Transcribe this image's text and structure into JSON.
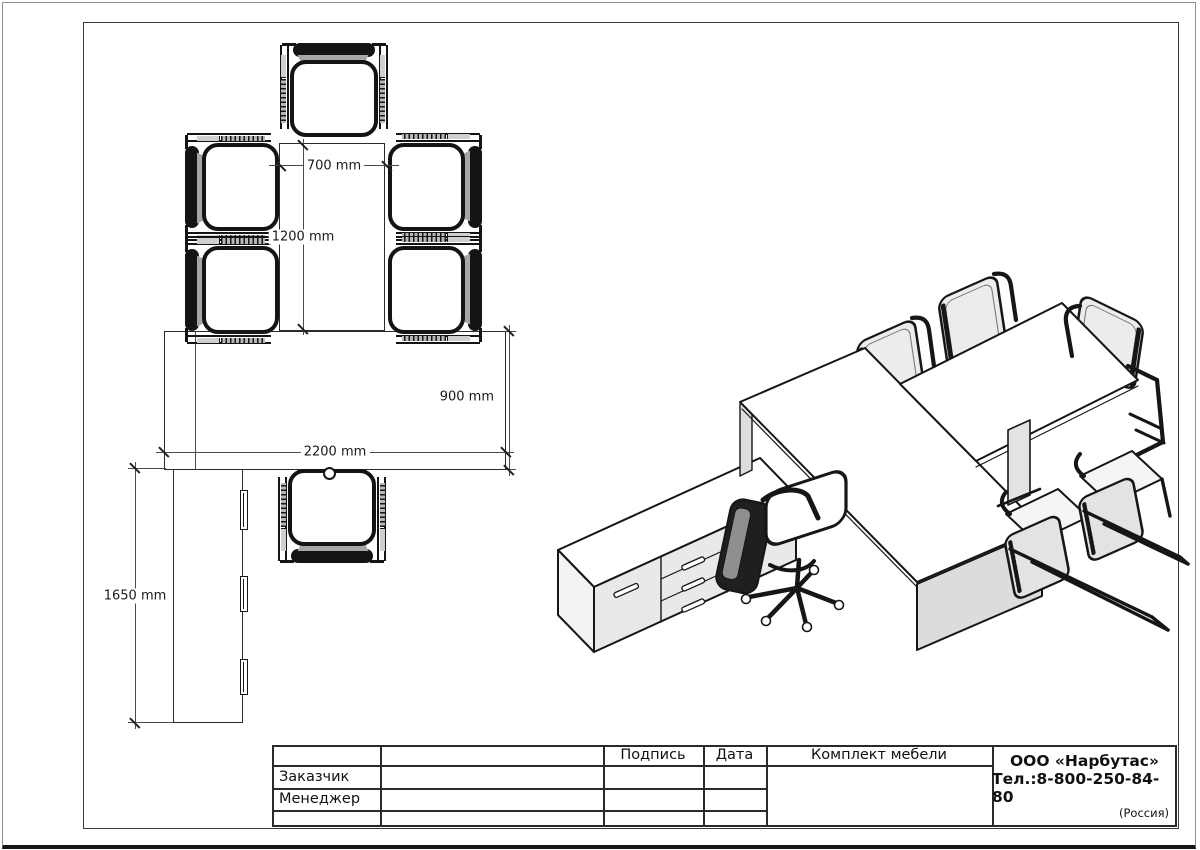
{
  "plan": {
    "dimensions": [
      {
        "id": "gap-width",
        "label": "700 mm"
      },
      {
        "id": "table-length",
        "label": "1200 mm"
      },
      {
        "id": "desk-depth",
        "label": "900 mm"
      },
      {
        "id": "desk-width",
        "label": "2200 mm"
      },
      {
        "id": "credenza-length",
        "label": "1650 mm"
      }
    ]
  },
  "title_block": {
    "col_signature": "Подпись",
    "col_date": "Дата",
    "product": "Комплект мебели",
    "row_customer": "Заказчик",
    "row_manager": "Менеджер",
    "company": {
      "name": "ООО «Нарбутас»",
      "phone": "Тел.:8-800-250-84-80",
      "country": "(Россия)"
    }
  },
  "colors": {
    "line": "#161616",
    "shade_gray": "#dcdcdc",
    "cushion_gray": "#a6a6a6"
  }
}
